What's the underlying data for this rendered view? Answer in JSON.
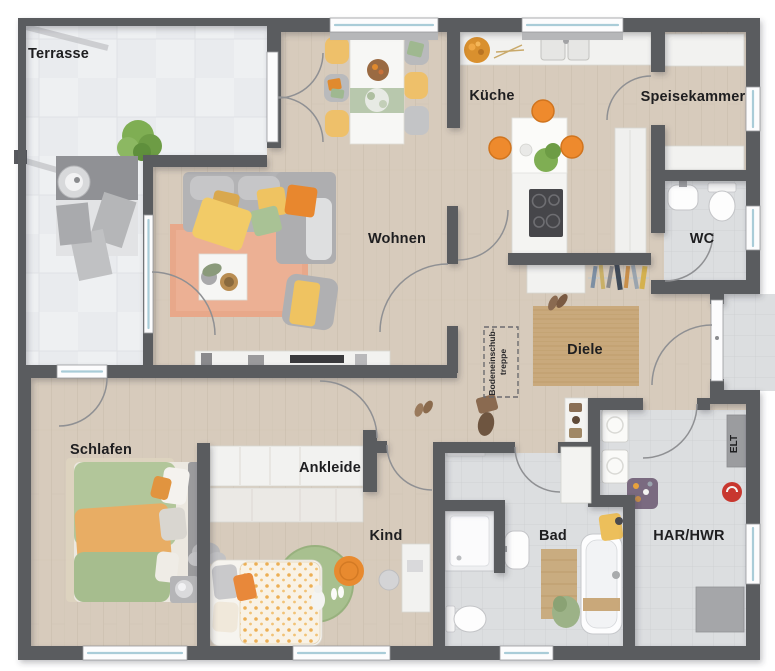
{
  "plan": {
    "rooms": {
      "terrasse": "Terrasse",
      "wohnen": "Wohnen",
      "kueche": "Küche",
      "speisekammer": "Speisekammer",
      "wc": "WC",
      "diele": "Diele",
      "schlafen": "Schlafen",
      "ankleide": "Ankleide",
      "kind": "Kind",
      "bad": "Bad",
      "har_hwr": "HAR/HWR",
      "elt": "ELT"
    },
    "annotations": {
      "attic_line1": "Bodeneinschub-",
      "attic_line2": "treppe"
    },
    "colors": {
      "wall": "#5A5B5F",
      "wood_floor": "#D7CBBC",
      "tile_floor": "#DCDEE0",
      "terrace_floor": "#EEF0F2",
      "diele_rug": "#C9A97C",
      "accent_orange": "#EE8A2D",
      "accent_yellow": "#EFC361",
      "accent_green": "#A9C295",
      "accent_salmon": "#E8A88A",
      "window_glass": "#A9CCD8",
      "label_text": "#1E1E20"
    }
  }
}
